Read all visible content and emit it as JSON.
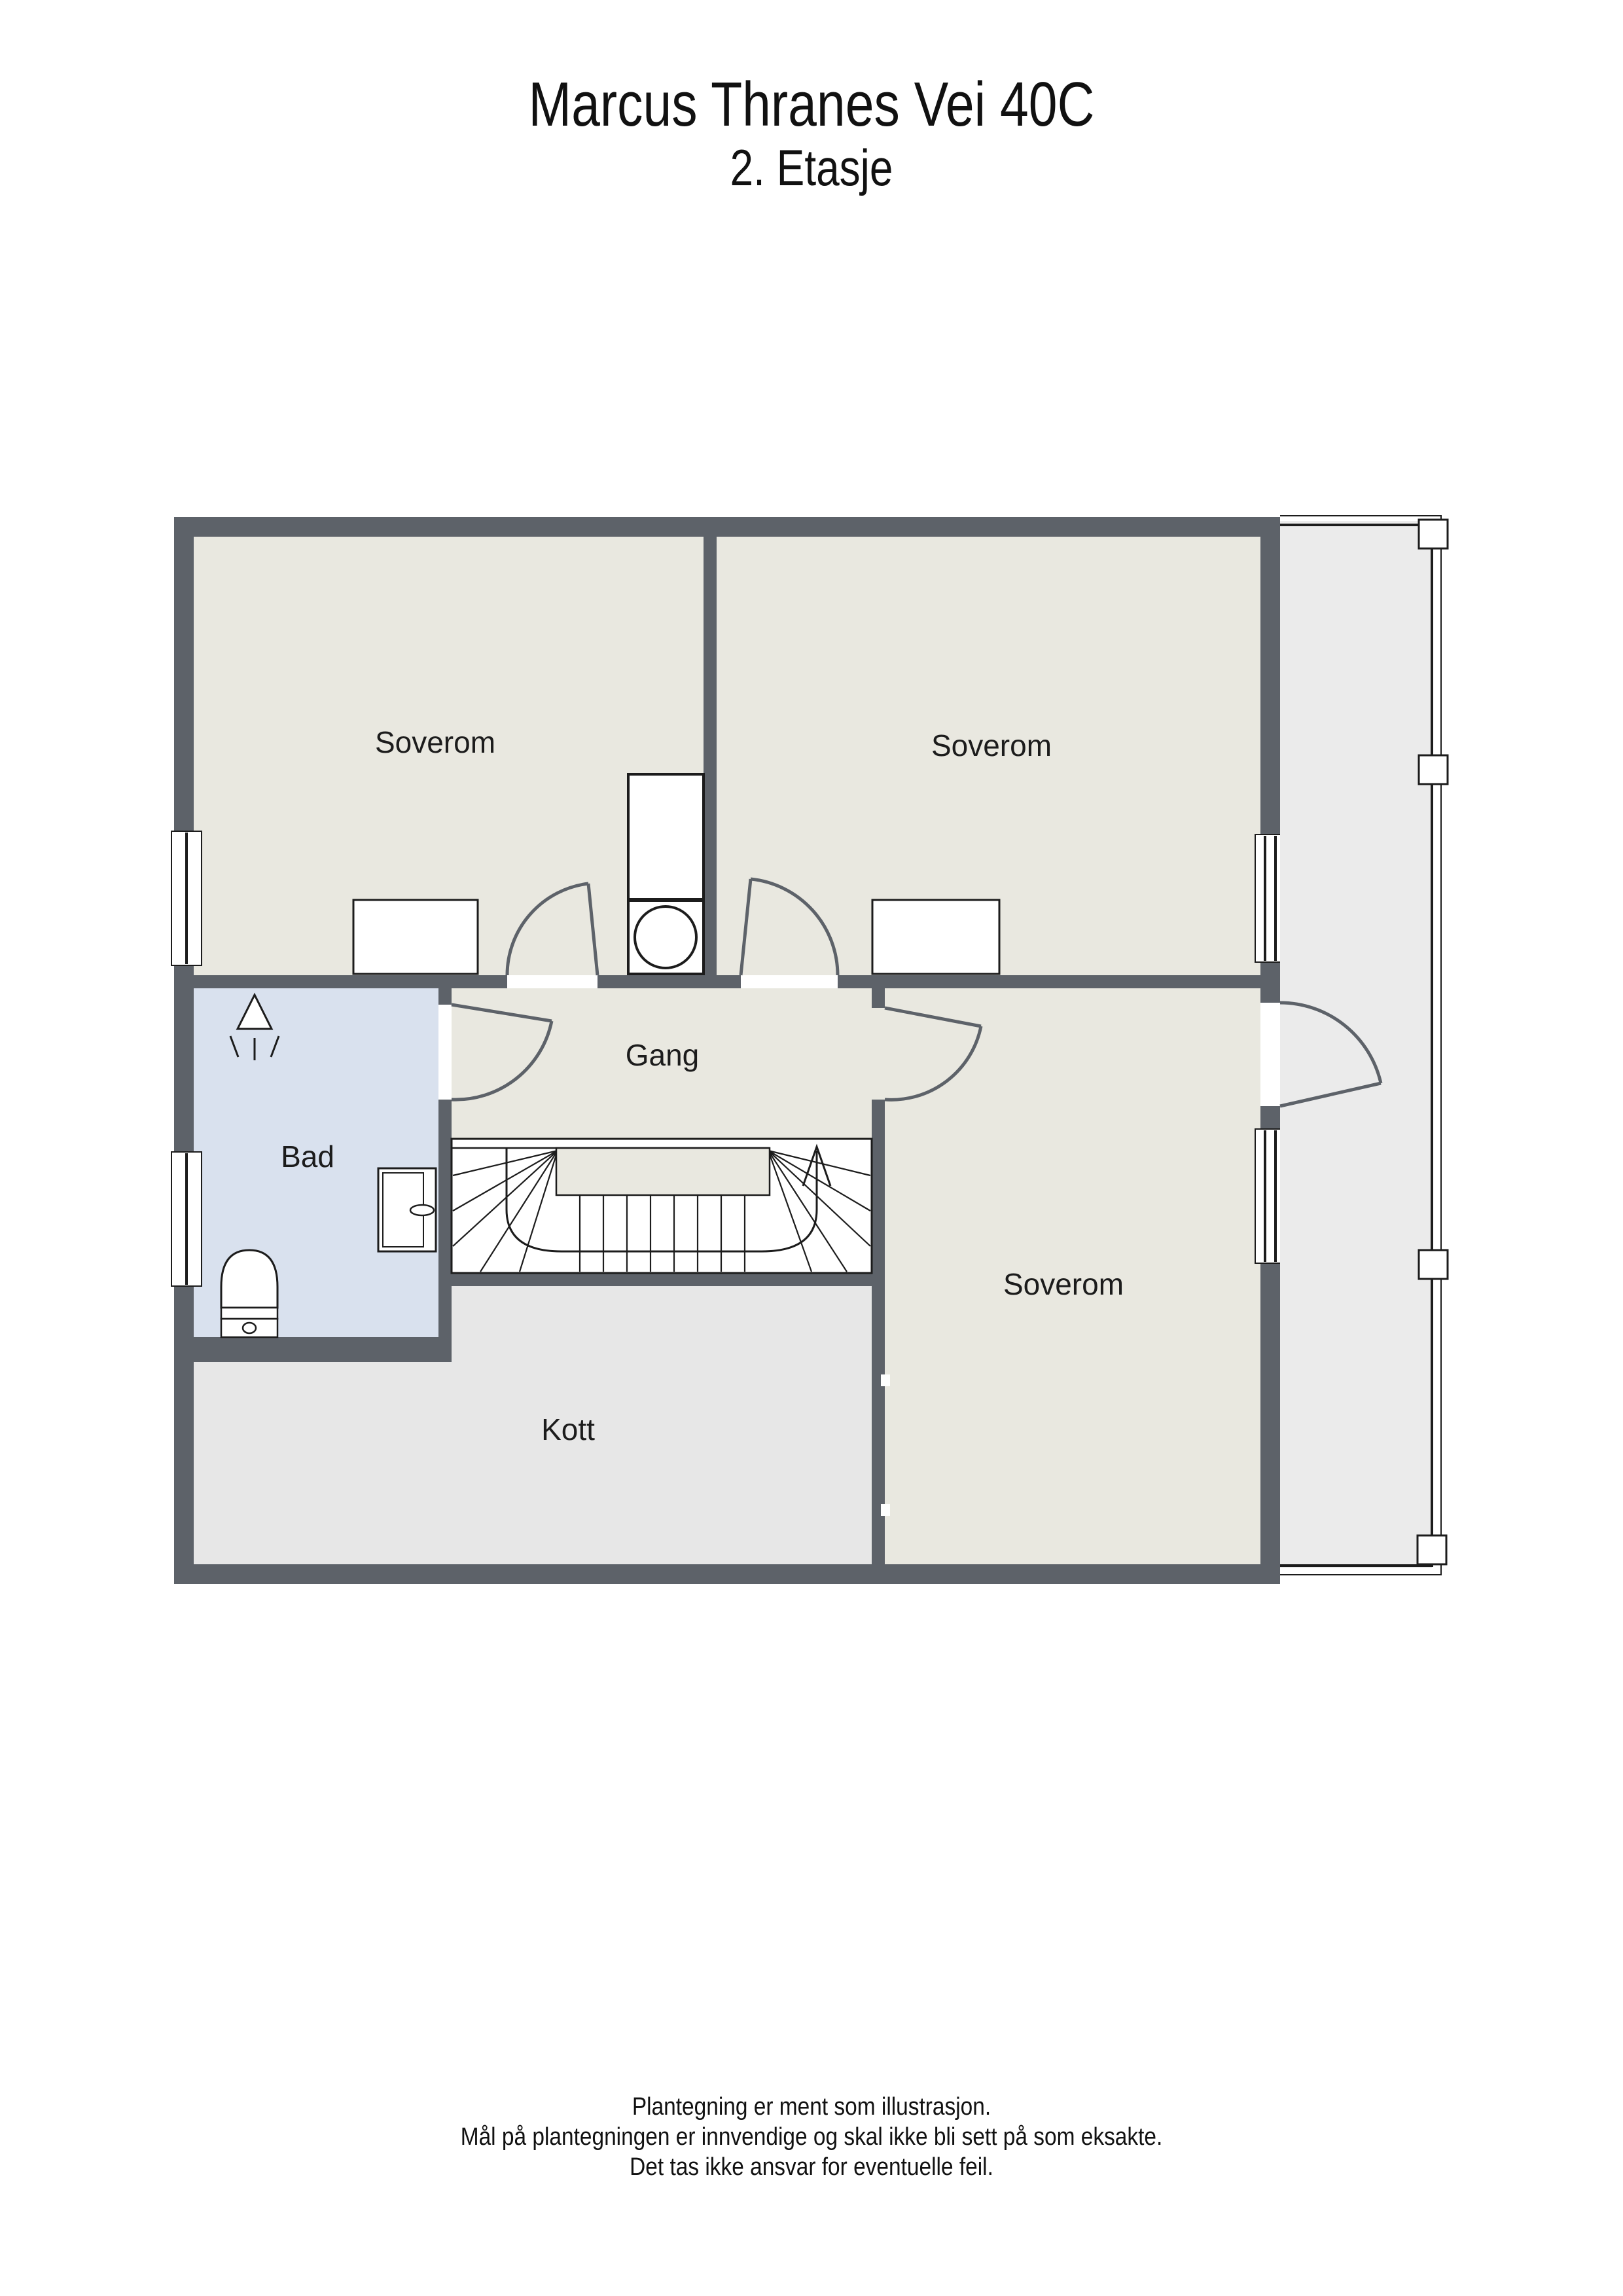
{
  "title": "Marcus Thranes Vei 40C",
  "subtitle": "2. Etasje",
  "rooms": {
    "bedroom_top_left": "Soverom",
    "bedroom_top_right": "Soverom",
    "bedroom_bottom_right": "Soverom",
    "hallway": "Gang",
    "bathroom": "Bad",
    "closet": "Kott"
  },
  "footer": {
    "line1": "Plantegning er ment som illustrasjon.",
    "line2": "Mål på plantegningen er innvendige og skal ikke bli sett på som eksakte.",
    "line3": "Det tas ikke ansvar for eventuelle feil."
  },
  "colors": {
    "wall": "#5d6269",
    "room": "#e9e8e0",
    "bathroom": "#d9e1ee",
    "closet": "#e7e7e7",
    "balcony": "#ebebeb",
    "outline": "#1c1c1c",
    "label": "#1c1c1c"
  }
}
